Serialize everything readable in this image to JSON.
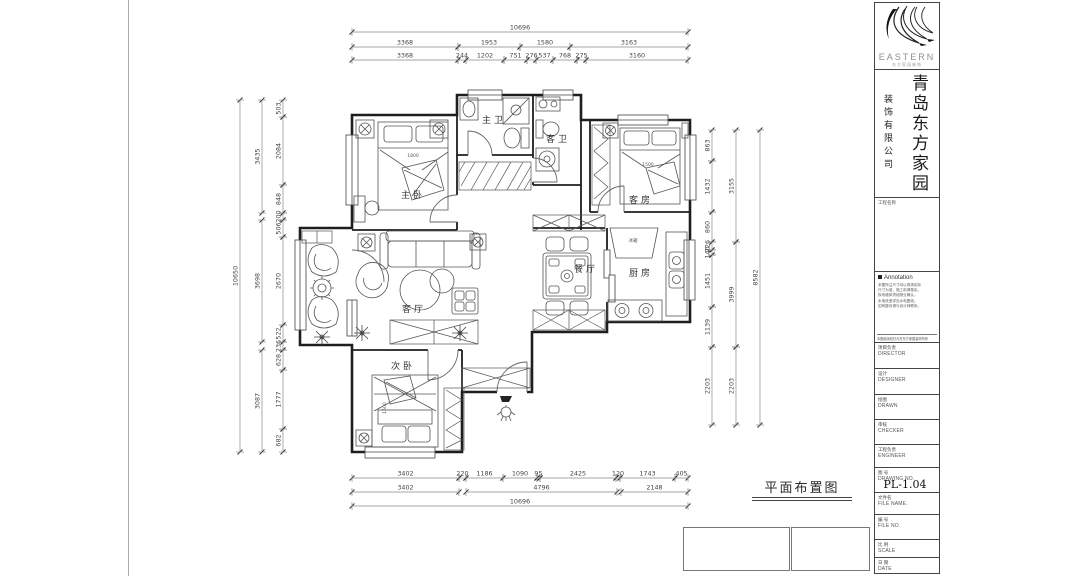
{
  "logo": {
    "brand": "EASTERN",
    "subtitle": "东方家园装饰"
  },
  "company": {
    "name_primary": "青岛东方家园",
    "name_secondary": "装饰有限公司"
  },
  "titleblock": {
    "project_label": "工程名称",
    "annotation_title": "Annotation",
    "notes": [
      "本图所注尺寸均以现场实际",
      "尺寸为准，施工前请核实。",
      "拆改墙体须经物业确认。",
      "水电改造详见水电图纸。",
      "如有疑问请与设计师联系。"
    ],
    "notes_footer": "本图纸版权归青岛东方家园装饰所有",
    "rows": [
      {
        "cn": "项目负责",
        "en": "DIRECTOR",
        "value": ""
      },
      {
        "cn": "设计",
        "en": "DESIGNER",
        "value": ""
      },
      {
        "cn": "绘图",
        "en": "DRAWN",
        "value": ""
      },
      {
        "cn": "审核",
        "en": "CHECKER",
        "value": ""
      },
      {
        "cn": "工程负责",
        "en": "ENGINEER",
        "value": ""
      },
      {
        "cn": "图 号",
        "en": "DRAWING NO.",
        "value": "PL-1.04"
      },
      {
        "cn": "文件名",
        "en": "FILE NAME.",
        "value": ""
      },
      {
        "cn": "编 号",
        "en": "FILE NO.",
        "value": ""
      },
      {
        "cn": "比 例",
        "en": "SCALE",
        "value": ""
      },
      {
        "cn": "日 期",
        "en": "DATE",
        "value": ""
      }
    ]
  },
  "plan": {
    "title": "平面布置图",
    "rooms": [
      {
        "id": "master-bedroom",
        "label": "主卧"
      },
      {
        "id": "master-bath",
        "label": "主卫"
      },
      {
        "id": "guest-bath",
        "label": "客卫"
      },
      {
        "id": "guest-room",
        "label": "客房"
      },
      {
        "id": "living-room",
        "label": "客厅"
      },
      {
        "id": "dining-room",
        "label": "餐厅"
      },
      {
        "id": "kitchen",
        "label": "厨房"
      },
      {
        "id": "second-bedroom",
        "label": "次卧"
      }
    ],
    "furniture_labels": {
      "master_bed": "1800",
      "guest_bed": "1500",
      "second_bed": "1500",
      "fridge": "冰箱"
    }
  },
  "dims": {
    "top_row1": [
      "10696"
    ],
    "top_row2": [
      "3368",
      "1953",
      "1580",
      "3163"
    ],
    "top_row3": [
      "3368",
      "244",
      "1202",
      "751",
      "276",
      "537",
      "768",
      "275",
      "3160"
    ],
    "bottom_row1": [
      "3402",
      "220",
      "1186",
      "1090",
      "95",
      "2425",
      "120",
      "1743",
      "405"
    ],
    "bottom_row2": [
      "3402",
      "4796",
      "2148"
    ],
    "bottom_row3": [
      "10696"
    ],
    "left_outer": [
      "10650"
    ],
    "left_mid": [
      "3435",
      "3698",
      "3087"
    ],
    "left_inner": [
      "503",
      "2084",
      "848",
      "200",
      "506",
      "2670",
      "522",
      "236",
      "628",
      "1777",
      "682"
    ],
    "right_inner": [
      "863",
      "1432",
      "860",
      "226",
      "140",
      "1451",
      "1139",
      "2203"
    ],
    "right_mid": [
      "3155",
      "3999",
      "2203"
    ],
    "right_outer": [
      "8582"
    ]
  }
}
